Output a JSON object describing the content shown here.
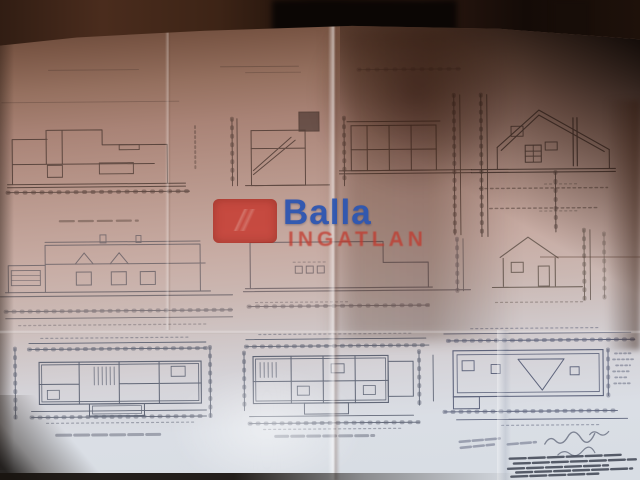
{
  "watermark": {
    "brand": "Balla",
    "subtitle": "INGATLAN",
    "brand_color": "#2d56b2",
    "subtitle_color": "#c2382c",
    "logo_color": "#c8372d",
    "logo_icon": "balla-square-logo"
  },
  "palette": {
    "background": "#120a06",
    "paper_shadow_top": "#6b4a39",
    "paper_light_bottom": "#dadee5",
    "ink_upper": "#41302a",
    "ink_lower": "#4d5466"
  }
}
